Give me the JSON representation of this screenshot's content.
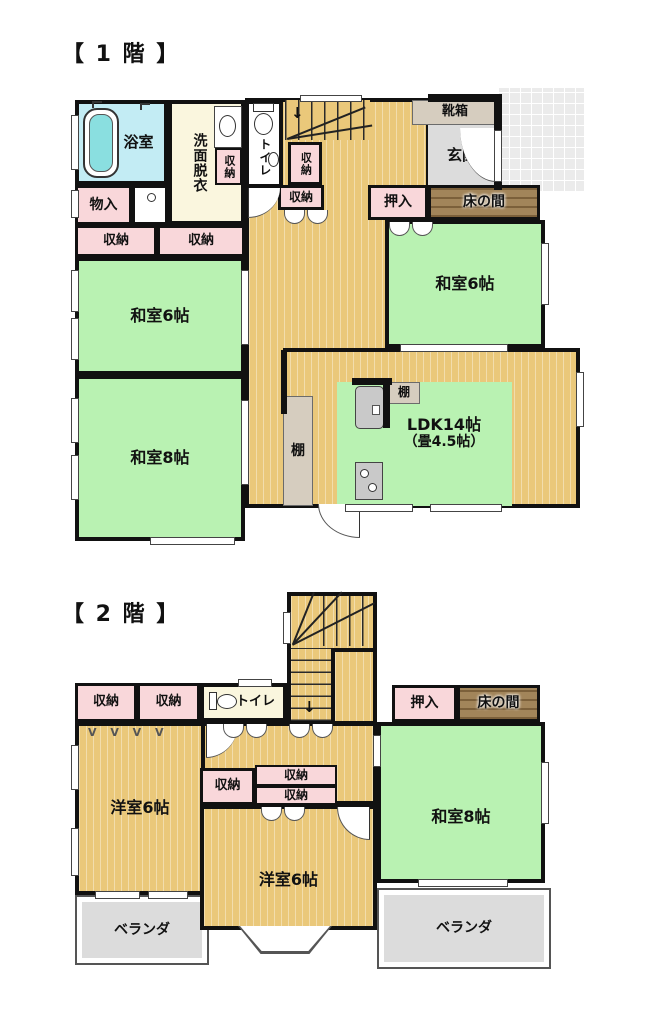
{
  "floor1": {
    "title": "【 1 階 】",
    "bath": "浴室",
    "washroom": "洗面脱衣",
    "storage_wash": "収納",
    "toilet": "トイレ",
    "monoire": "物入",
    "storage_a": "収納",
    "storage_b": "収納",
    "storage_stairs_v": "収納",
    "storage_stairs_h": "収納",
    "washitsu6_left": "和室6帖",
    "washitsu8": "和室8帖",
    "shoebox": "靴箱",
    "genkan": "玄関",
    "oshiire": "押入",
    "tokonoma": "床の間",
    "washitsu6_right": "和室6帖",
    "shelf_tall": "棚",
    "shelf_small": "棚",
    "ldk_line1": "LDK14帖",
    "ldk_line2": "（畳4.5帖）"
  },
  "floor2": {
    "title": "【 2 階 】",
    "storage_a": "収納",
    "storage_b": "収納",
    "toilet": "トイレ",
    "oshiire": "押入",
    "tokonoma": "床の間",
    "yoshitsu6_left": "洋室6帖",
    "washitsu8": "和室8帖",
    "storage_c": "収納",
    "storage_d": "収納",
    "storage_e": "収納",
    "yoshitsu6_mid": "洋室6帖",
    "veranda_left": "ベランダ",
    "veranda_right": "ベランダ",
    "fold_marks": "V V V V"
  },
  "colors": {
    "wood_floor": "#eac87a",
    "tatami_green": "#b9f2b2",
    "closet_pink": "#f9d7da",
    "bath_blue": "#c3ecf4",
    "washroom_cream": "#faf6de",
    "entrance_gray": "#dcdcdc",
    "tokonoma_brown": "#a2855a",
    "shelf_beige": "#d6cdbf",
    "veranda_gray": "#dcdcdc",
    "wall_black": "#111111"
  }
}
